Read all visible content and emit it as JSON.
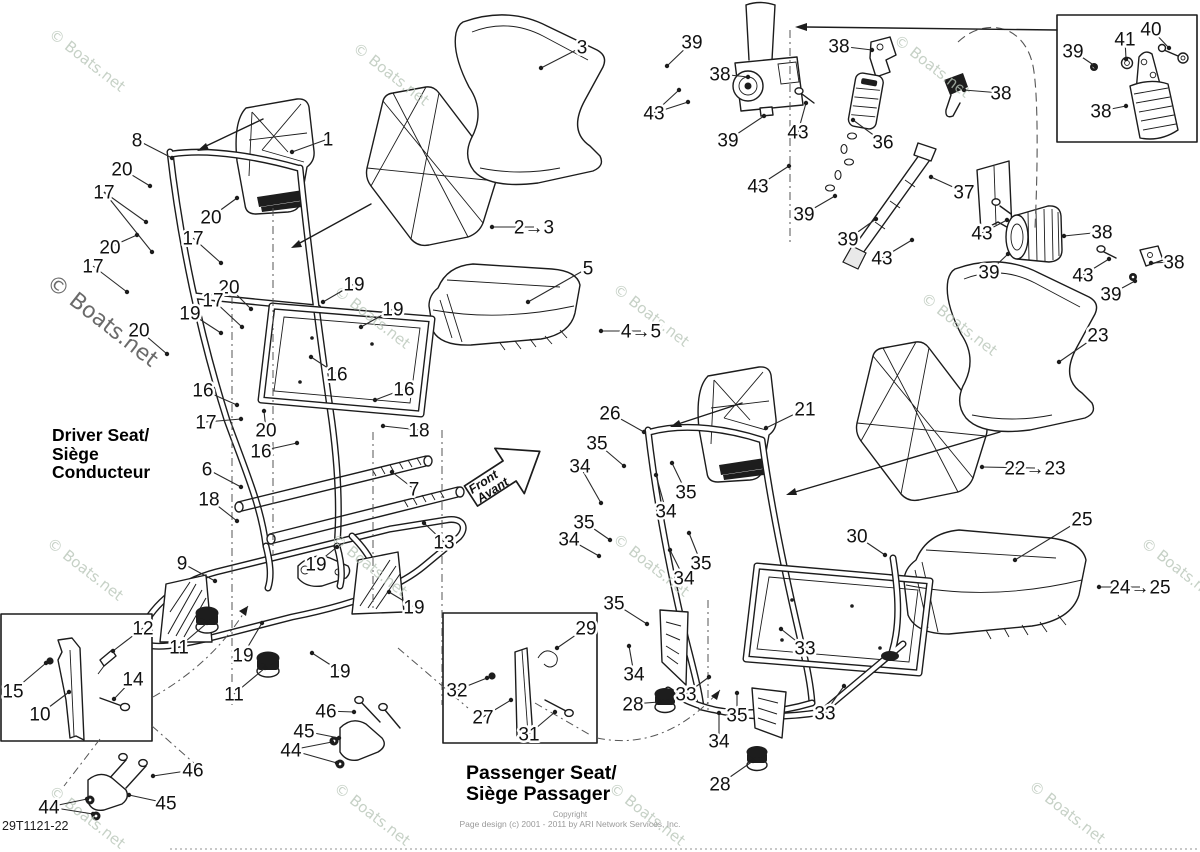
{
  "page": {
    "diagram_id": "29T1121-22",
    "watermark_text": "© Boats.net",
    "copyright_line1": "Copyright",
    "copyright_line2": "Page design (c) 2001 - 2011 by ARI Network Services, Inc."
  },
  "labels": {
    "driver_seat": [
      "Driver Seat/",
      "Siège",
      "Conducteur"
    ],
    "passenger_seat": [
      "Passenger Seat/",
      "Siège Passager"
    ],
    "front_arrow": [
      "Front",
      "Avant"
    ]
  },
  "colors": {
    "line": "#1c1c1c",
    "watermark": "#b9c6b9",
    "watermark_dark": "#5e5e5e",
    "muted_text": "#999999"
  },
  "watermarks": [
    {
      "x": 48,
      "y": 36
    },
    {
      "x": 352,
      "y": 50
    },
    {
      "x": 893,
      "y": 42
    },
    {
      "x": 45,
      "y": 285,
      "big": true
    },
    {
      "x": 333,
      "y": 293
    },
    {
      "x": 612,
      "y": 291
    },
    {
      "x": 920,
      "y": 300
    },
    {
      "x": 46,
      "y": 545
    },
    {
      "x": 330,
      "y": 541
    },
    {
      "x": 612,
      "y": 541
    },
    {
      "x": 1140,
      "y": 545
    },
    {
      "x": 48,
      "y": 793
    },
    {
      "x": 333,
      "y": 790
    },
    {
      "x": 608,
      "y": 790
    },
    {
      "x": 1028,
      "y": 788
    }
  ],
  "callouts": [
    {
      "n": "8",
      "x": 137,
      "y": 140,
      "lx": 172,
      "ly": 158
    },
    {
      "n": "1",
      "x": 328,
      "y": 139,
      "lx": 292,
      "ly": 152
    },
    {
      "n": "20",
      "x": 122,
      "y": 169,
      "lx": 150,
      "ly": 186
    },
    {
      "n": "17",
      "x": 104,
      "y": 192,
      "lx": 146,
      "ly": 222,
      "lx2": 152,
      "ly2": 252
    },
    {
      "n": "20",
      "x": 211,
      "y": 217,
      "lx": 237,
      "ly": 198
    },
    {
      "n": "17",
      "x": 193,
      "y": 238,
      "lx": 221,
      "ly": 263
    },
    {
      "n": "20",
      "x": 110,
      "y": 247,
      "lx": 137,
      "ly": 235
    },
    {
      "n": "17",
      "x": 93,
      "y": 266,
      "lx": 127,
      "ly": 292
    },
    {
      "n": "3",
      "x": 582,
      "y": 47,
      "lx": 541,
      "ly": 68
    },
    {
      "n": "2→3",
      "x": 534,
      "y": 227,
      "lx": 492,
      "ly": 227
    },
    {
      "n": "5",
      "x": 588,
      "y": 268,
      "lx": 528,
      "ly": 302
    },
    {
      "n": "4→5",
      "x": 641,
      "y": 331,
      "lx": 601,
      "ly": 331
    },
    {
      "n": "20",
      "x": 229,
      "y": 287,
      "lx": 251,
      "ly": 309
    },
    {
      "n": "17",
      "x": 213,
      "y": 300,
      "lx": 242,
      "ly": 327
    },
    {
      "n": "19",
      "x": 190,
      "y": 313,
      "lx": 221,
      "ly": 333
    },
    {
      "n": "20",
      "x": 139,
      "y": 330,
      "lx": 167,
      "ly": 354
    },
    {
      "n": "19",
      "x": 354,
      "y": 284,
      "lx": 323,
      "ly": 302
    },
    {
      "n": "19",
      "x": 393,
      "y": 309,
      "lx": 361,
      "ly": 327
    },
    {
      "n": "16",
      "x": 337,
      "y": 374,
      "lx": 311,
      "ly": 357
    },
    {
      "n": "16",
      "x": 404,
      "y": 389,
      "lx": 375,
      "ly": 400
    },
    {
      "n": "16",
      "x": 203,
      "y": 390,
      "lx": 237,
      "ly": 405
    },
    {
      "n": "17",
      "x": 206,
      "y": 422,
      "lx": 241,
      "ly": 419
    },
    {
      "n": "20",
      "x": 266,
      "y": 430,
      "lx": 264,
      "ly": 411
    },
    {
      "n": "16",
      "x": 261,
      "y": 451,
      "lx": 297,
      "ly": 443
    },
    {
      "n": "18",
      "x": 419,
      "y": 430,
      "lx": 383,
      "ly": 426
    },
    {
      "n": "6",
      "x": 207,
      "y": 469,
      "lx": 241,
      "ly": 487
    },
    {
      "n": "7",
      "x": 414,
      "y": 489,
      "lx": 392,
      "ly": 472
    },
    {
      "n": "18",
      "x": 209,
      "y": 499,
      "lx": 237,
      "ly": 521
    },
    {
      "n": "13",
      "x": 444,
      "y": 542,
      "lx": 424,
      "ly": 523
    },
    {
      "n": "9",
      "x": 182,
      "y": 563,
      "lx": 215,
      "ly": 581
    },
    {
      "n": "19",
      "x": 316,
      "y": 564,
      "lx": 337,
      "ly": 547
    },
    {
      "n": "19",
      "x": 414,
      "y": 607,
      "lx": 389,
      "ly": 592
    },
    {
      "n": "12",
      "x": 143,
      "y": 628,
      "lx": 113,
      "ly": 651
    },
    {
      "n": "11",
      "x": 179,
      "y": 647,
      "lx": 207,
      "ly": 623
    },
    {
      "n": "19",
      "x": 243,
      "y": 655,
      "lx": 262,
      "ly": 623
    },
    {
      "n": "11",
      "x": 234,
      "y": 694,
      "lx": 265,
      "ly": 668
    },
    {
      "n": "19",
      "x": 340,
      "y": 671,
      "lx": 312,
      "ly": 653
    },
    {
      "n": "15",
      "x": 13,
      "y": 691,
      "lx": 46,
      "ly": 663
    },
    {
      "n": "10",
      "x": 40,
      "y": 714,
      "lx": 69,
      "ly": 692
    },
    {
      "n": "14",
      "x": 133,
      "y": 679,
      "lx": 114,
      "ly": 699
    },
    {
      "n": "46",
      "x": 326,
      "y": 711,
      "lx": 354,
      "ly": 712
    },
    {
      "n": "45",
      "x": 304,
      "y": 731,
      "lx": 339,
      "ly": 738
    },
    {
      "n": "44",
      "x": 291,
      "y": 750,
      "lx": 332,
      "ly": 742,
      "lx2": 337,
      "ly2": 763
    },
    {
      "n": "46",
      "x": 193,
      "y": 770,
      "lx": 153,
      "ly": 776
    },
    {
      "n": "45",
      "x": 166,
      "y": 803,
      "lx": 129,
      "ly": 795
    },
    {
      "n": "44",
      "x": 49,
      "y": 807,
      "lx": 87,
      "ly": 799,
      "lx2": 93,
      "ly2": 814
    },
    {
      "n": "26",
      "x": 610,
      "y": 413,
      "lx": 644,
      "ly": 432
    },
    {
      "n": "21",
      "x": 805,
      "y": 409,
      "lx": 766,
      "ly": 428
    },
    {
      "n": "35",
      "x": 597,
      "y": 443,
      "lx": 624,
      "ly": 466
    },
    {
      "n": "34",
      "x": 580,
      "y": 466,
      "lx": 601,
      "ly": 503
    },
    {
      "n": "35",
      "x": 584,
      "y": 522,
      "lx": 610,
      "ly": 540
    },
    {
      "n": "34",
      "x": 569,
      "y": 539,
      "lx": 599,
      "ly": 556
    },
    {
      "n": "35",
      "x": 686,
      "y": 492,
      "lx": 672,
      "ly": 463
    },
    {
      "n": "34",
      "x": 666,
      "y": 511,
      "lx": 656,
      "ly": 475
    },
    {
      "n": "35",
      "x": 701,
      "y": 563,
      "lx": 689,
      "ly": 533
    },
    {
      "n": "34",
      "x": 684,
      "y": 578,
      "lx": 670,
      "ly": 550
    },
    {
      "n": "35",
      "x": 614,
      "y": 603,
      "lx": 647,
      "ly": 624
    },
    {
      "n": "34",
      "x": 634,
      "y": 674,
      "lx": 629,
      "ly": 646
    },
    {
      "n": "28",
      "x": 633,
      "y": 704,
      "lx": 659,
      "ly": 702
    },
    {
      "n": "33",
      "x": 686,
      "y": 694,
      "lx": 709,
      "ly": 677
    },
    {
      "n": "35",
      "x": 737,
      "y": 715,
      "lx": 737,
      "ly": 693
    },
    {
      "n": "34",
      "x": 719,
      "y": 741,
      "lx": 719,
      "ly": 713
    },
    {
      "n": "33",
      "x": 805,
      "y": 648,
      "lx": 781,
      "ly": 629
    },
    {
      "n": "33",
      "x": 825,
      "y": 713,
      "lx": 844,
      "ly": 686
    },
    {
      "n": "28",
      "x": 720,
      "y": 784,
      "lx": 753,
      "ly": 761
    },
    {
      "n": "30",
      "x": 857,
      "y": 536,
      "lx": 885,
      "ly": 555
    },
    {
      "n": "29",
      "x": 586,
      "y": 628,
      "lx": 557,
      "ly": 648
    },
    {
      "n": "32",
      "x": 457,
      "y": 690,
      "lx": 487,
      "ly": 678
    },
    {
      "n": "27",
      "x": 483,
      "y": 717,
      "lx": 511,
      "ly": 700
    },
    {
      "n": "31",
      "x": 529,
      "y": 734,
      "lx": 555,
      "ly": 712
    },
    {
      "n": "23",
      "x": 1098,
      "y": 335,
      "lx": 1059,
      "ly": 362
    },
    {
      "n": "22→23",
      "x": 1035,
      "y": 468,
      "lx": 982,
      "ly": 467
    },
    {
      "n": "25",
      "x": 1082,
      "y": 519,
      "lx": 1015,
      "ly": 560
    },
    {
      "n": "24→25",
      "x": 1140,
      "y": 587,
      "lx": 1099,
      "ly": 587
    },
    {
      "n": "39",
      "x": 692,
      "y": 42,
      "lx": 667,
      "ly": 66
    },
    {
      "n": "38",
      "x": 839,
      "y": 46,
      "lx": 872,
      "ly": 50
    },
    {
      "n": "38",
      "x": 720,
      "y": 74,
      "lx": 748,
      "ly": 77
    },
    {
      "n": "43",
      "x": 654,
      "y": 113,
      "lx": 679,
      "ly": 90,
      "lx2": 688,
      "ly2": 102
    },
    {
      "n": "39",
      "x": 728,
      "y": 140,
      "lx": 764,
      "ly": 116
    },
    {
      "n": "43",
      "x": 798,
      "y": 132,
      "lx": 806,
      "ly": 103
    },
    {
      "n": "36",
      "x": 883,
      "y": 142,
      "lx": 853,
      "ly": 120
    },
    {
      "n": "38",
      "x": 1001,
      "y": 93,
      "lx": 964,
      "ly": 90
    },
    {
      "n": "43",
      "x": 758,
      "y": 186,
      "lx": 789,
      "ly": 166
    },
    {
      "n": "39",
      "x": 804,
      "y": 214,
      "lx": 835,
      "ly": 196
    },
    {
      "n": "37",
      "x": 964,
      "y": 192,
      "lx": 931,
      "ly": 177
    },
    {
      "n": "39",
      "x": 848,
      "y": 239,
      "lx": 876,
      "ly": 219
    },
    {
      "n": "43",
      "x": 882,
      "y": 258,
      "lx": 912,
      "ly": 240
    },
    {
      "n": "43",
      "x": 982,
      "y": 233,
      "lx": 1007,
      "ly": 220
    },
    {
      "n": "38",
      "x": 1102,
      "y": 232,
      "lx": 1064,
      "ly": 236
    },
    {
      "n": "39",
      "x": 989,
      "y": 272,
      "lx": 1008,
      "ly": 254
    },
    {
      "n": "43",
      "x": 1083,
      "y": 275,
      "lx": 1109,
      "ly": 259
    },
    {
      "n": "38",
      "x": 1174,
      "y": 262,
      "lx": 1151,
      "ly": 263
    },
    {
      "n": "39",
      "x": 1111,
      "y": 294,
      "lx": 1135,
      "ly": 281
    },
    {
      "n": "39",
      "x": 1073,
      "y": 51,
      "lx": 1095,
      "ly": 66
    },
    {
      "n": "41",
      "x": 1125,
      "y": 39,
      "lx": 1126,
      "ly": 59
    },
    {
      "n": "40",
      "x": 1151,
      "y": 29,
      "lx": 1169,
      "ly": 48
    },
    {
      "n": "38",
      "x": 1101,
      "y": 111,
      "lx": 1126,
      "ly": 106
    }
  ]
}
